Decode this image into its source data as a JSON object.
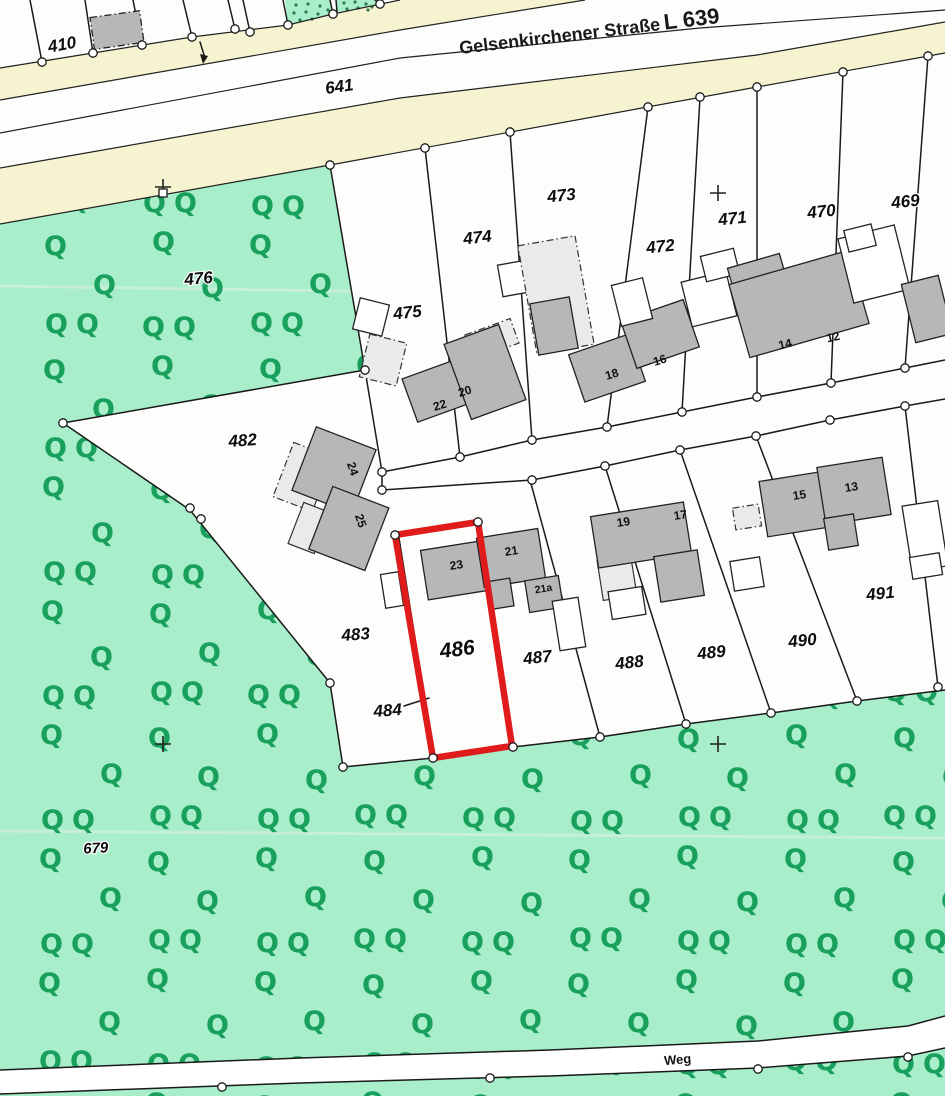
{
  "map_title": "Liegenschaftskarte Ausschnitt",
  "labels": {
    "street_name": "Gelsenkirchener Straße",
    "street_code": "L 639",
    "path": "Weg",
    "parcels": {
      "p410": "410",
      "p641": "641",
      "p469": "469",
      "p470": "470",
      "p471": "471",
      "p472": "472",
      "p473": "473",
      "p474": "474",
      "p475": "475",
      "p476": "476",
      "p482": "482",
      "p483": "483",
      "p484": "484",
      "p486": "486",
      "p487": "487",
      "p488": "488",
      "p489": "489",
      "p490": "490",
      "p491": "491",
      "p679": "679"
    },
    "houses": {
      "h12": "12",
      "h13": "13",
      "h14": "14",
      "h15": "15",
      "h16": "16",
      "h17": "17",
      "h18": "18",
      "h19": "19",
      "h20": "20",
      "h21": "21",
      "h21a": "21a",
      "h22": "22",
      "h23": "23",
      "h24": "24",
      "h25": "25"
    }
  },
  "symbols": {
    "tree_glyph": "Q"
  },
  "highlight": {
    "parcel": "486",
    "color": "#df1b1b"
  },
  "colors": {
    "vegetation": "#a8eeca",
    "tree_green": "#18a05c",
    "street_band": "#f6f4d0",
    "building_gray": "#b7b7b7",
    "building_annex": "#eaeaea",
    "boundary_line": "#1a1a1a",
    "paper": "#fdfdfb"
  }
}
